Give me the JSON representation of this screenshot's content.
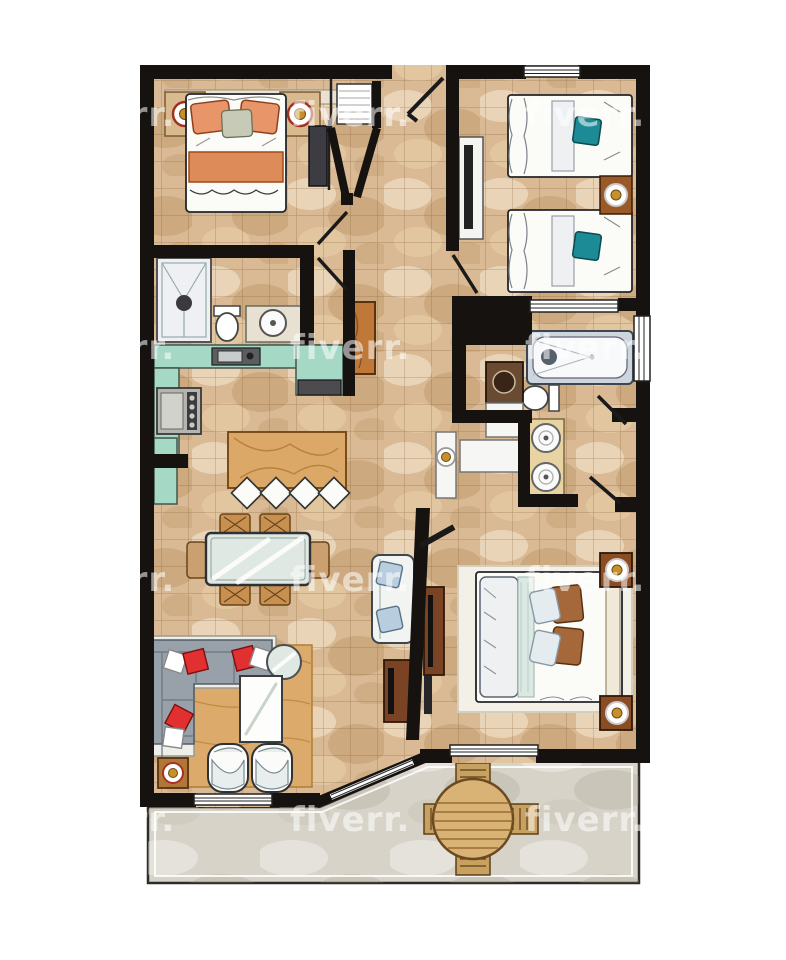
{
  "title": "Two-bedroom apartment floor plan, hand-drawn watercolor style, top-down view with furnished rooms and rear patio",
  "watermark": {
    "text": "fiverr.",
    "color": "#ffffff",
    "opacity": 0.55,
    "font_size_px": 34,
    "grid": {
      "columns_x": [
        55,
        290,
        525
      ],
      "rows_y": [
        95,
        328,
        560,
        800
      ]
    }
  },
  "palette": {
    "background": "#ffffff",
    "walls": "#151210",
    "floor_tile": "#d9ba94",
    "floor_grout": "#7d552d",
    "patio_stone": "#d7d3c9",
    "kitchen_counter_teal": "#a5d9c6",
    "island_wood": "#dca868",
    "area_rug_wood": "#dcaa6a",
    "sofa_gray": "#98a1a9",
    "pillow_red": "#e23030",
    "pillow_teal": "#1d8b96",
    "pillow_orange": "#e8956a",
    "pillow_brown": "#a5683a",
    "pillow_blue": "#b8cede",
    "blanket_orange": "#dd8b58",
    "dark_wood": "#7a4424",
    "vanity_sand": "#e8d3a2",
    "lamp_gold": "#c89028",
    "glass_green": "#dfe8e2",
    "fixture_white": "#f6f7f5"
  },
  "rooms": [
    {
      "id": "bedroom-1",
      "label": "Bedroom 1 (top left)",
      "furniture": [
        "double bed with orange pillows and orange blanket",
        "left nightstand with lamp",
        "right nightstand with lamp",
        "wall TV",
        "closet with louvered door"
      ]
    },
    {
      "id": "entry-hall",
      "label": "Entry hall (top center)",
      "furniture": [
        "entry door",
        "angled hall closet",
        "tall wood cabinet"
      ]
    },
    {
      "id": "bedroom-2",
      "label": "Bedroom 2 (top right, twin)",
      "furniture": [
        "twin bed with teal pillow (upper)",
        "twin bed with teal pillow (lower)",
        "shared nightstand with lamp",
        "TV console",
        "window"
      ]
    },
    {
      "id": "bathroom-1",
      "label": "Bathroom 1 (left)",
      "furniture": [
        "shower",
        "toilet",
        "washbasin vanity"
      ]
    },
    {
      "id": "kitchen",
      "label": "Kitchen (open, left center)",
      "furniture": [
        "L-shaped teal counter",
        "sink",
        "stove",
        "oven appliance",
        "wood island",
        "4 bar stools"
      ]
    },
    {
      "id": "bathroom-2",
      "label": "Bathroom 2 / laundry (right center)",
      "furniture": [
        "bathtub",
        "toilet",
        "washing machine",
        "white counters",
        "console with lamp",
        "double-sink vanity",
        "two swing doors"
      ]
    },
    {
      "id": "living-dining",
      "label": "Living / dining (bottom left)",
      "furniture": [
        "glass dining table",
        "4 side chairs",
        "2 end armchairs",
        "L-shaped gray sectional sofa",
        "red and white throw pillows",
        "white coffee table",
        "round glass side table",
        "2 white tub chairs",
        "corner lamp table",
        "white loveseat with blue pillows",
        "living TV console",
        "wood area rug"
      ]
    },
    {
      "id": "master-bedroom",
      "label": "Master bedroom (bottom right)",
      "furniture": [
        "double bed with brown and blue pillows",
        "white area rug",
        "2 nightstands with lamps",
        "TV console",
        "window"
      ]
    },
    {
      "id": "patio",
      "label": "Patio / terrace (bottom)",
      "furniture": [
        "round wood table",
        "4 wood chairs"
      ]
    }
  ]
}
